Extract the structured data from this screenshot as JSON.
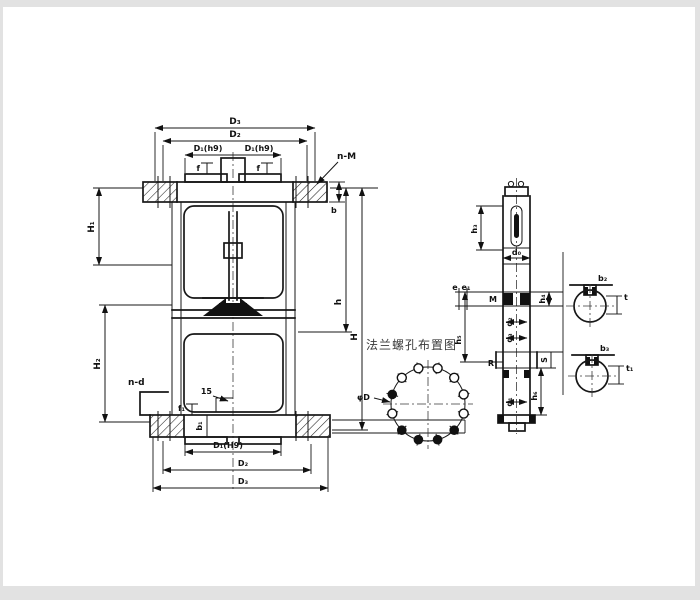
{
  "front_view": {
    "top": {
      "d3": "D₃",
      "d2": "D₂",
      "d1_left": "D₁(h9)",
      "d1_right": "D₁(h9)",
      "f_left": "f",
      "f_right": "f",
      "bolt_callout": "n-M",
      "flange_thickness": "b"
    },
    "left": {
      "upper_height": "H₁",
      "lower_height": "H₂"
    },
    "right": {
      "inner_height": "h",
      "total_height": "H"
    },
    "bottom": {
      "bolt_callout": "n-d",
      "step": "15",
      "f1": "f₁",
      "b1": "b₁",
      "d1": "D₁(H9)",
      "d2": "D₂",
      "d3": "D₃"
    }
  },
  "bolt_diagram": {
    "title": "法兰螺孔布置图",
    "diameter_label": "φD"
  },
  "stem_section": {
    "d0": "d₀",
    "h3": "h₃",
    "e": "e",
    "e1": "e₁",
    "thread": "M",
    "h4": "h₄",
    "d2": "d₂",
    "d3": "d₃",
    "h5": "h₅",
    "r": "R",
    "s": "S",
    "d1": "d₁",
    "h6": "h₆"
  },
  "details": {
    "top_label": "b₂",
    "top_thickness": "t",
    "bottom_label": "b₃",
    "bottom_thickness": "t₁"
  }
}
